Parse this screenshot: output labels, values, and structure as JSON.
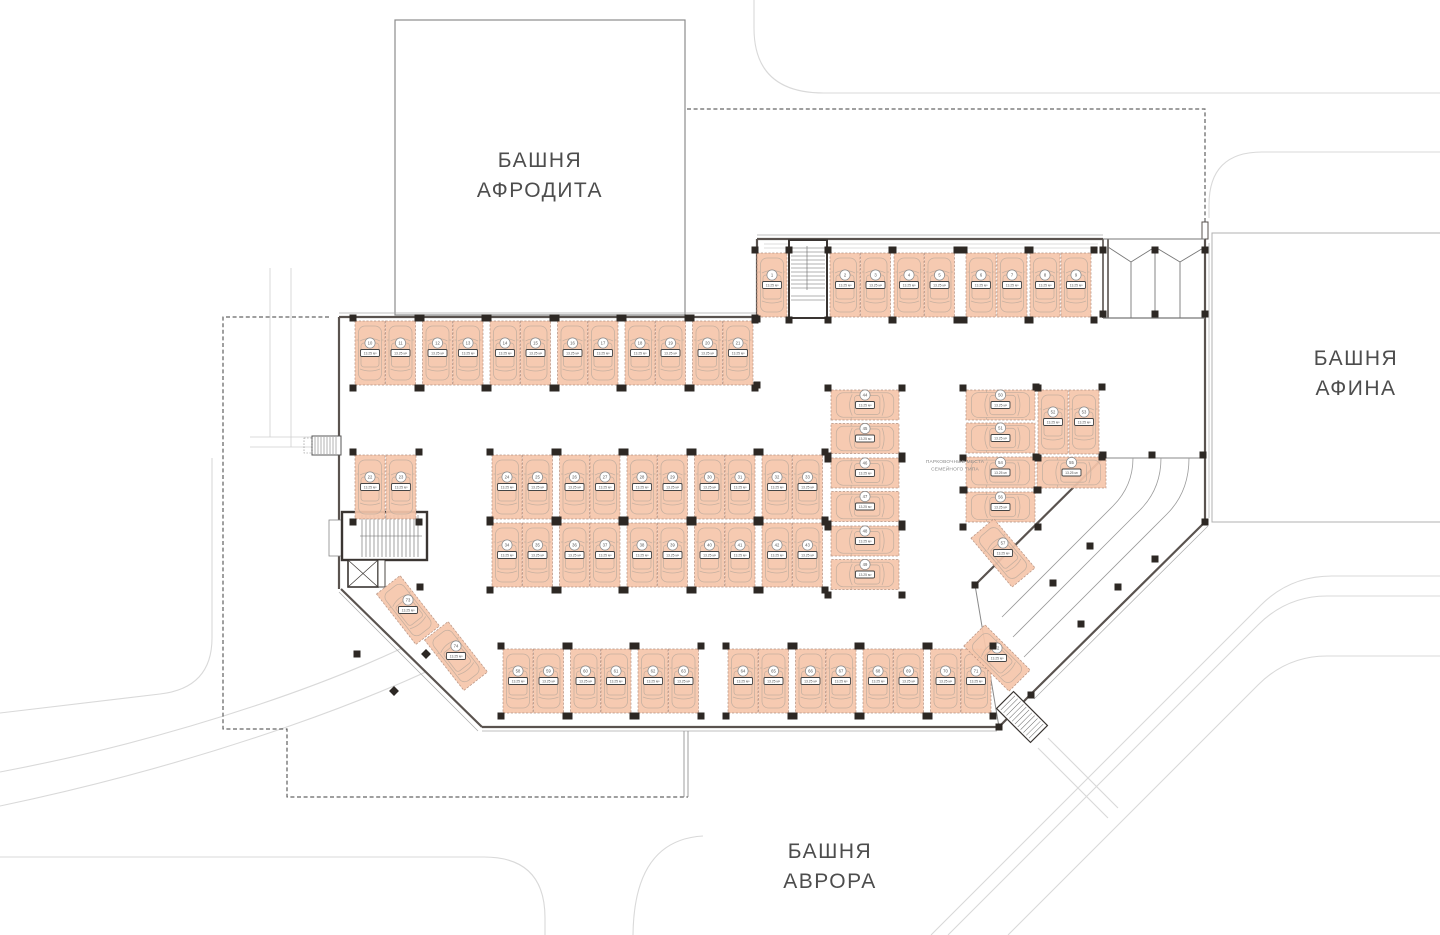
{
  "plan": {
    "towers": {
      "aphrodite": {
        "line1": "БАШНЯ",
        "line2": "АФРОДИТА"
      },
      "athena": {
        "line1": "БАШНЯ",
        "line2": "АФИНА"
      },
      "aurora": {
        "line1": "БАШНЯ",
        "line2": "АВРОРА"
      }
    },
    "annotation": {
      "line1": "ПАРКОВОЧНЫЕ МЕСТА",
      "line2": "СЕМЕЙНОГО ТИПА"
    },
    "stall_area_label": "13.25 м²",
    "total_stalls": 74,
    "colors": {
      "stall_fill": "#f5c5aa",
      "stall_border": "#b49181",
      "car_outline": "#c2ae9f",
      "wall": "#5a534f",
      "column": "#2d2824",
      "road": "#d9d9d9",
      "boundary": "#3f3f3f"
    },
    "stall_groups": [
      {
        "kind": "col-v",
        "x": 757,
        "y": 253,
        "count": 1,
        "pitch": 30.5,
        "pair_gap": 0,
        "len": 64
      },
      {
        "kind": "col-v",
        "x": 830,
        "y": 253,
        "count": 4,
        "pitch": 30.5,
        "pair_gap": 3,
        "len": 64
      },
      {
        "kind": "col-v",
        "x": 966,
        "y": 253,
        "count": 4,
        "pitch": 31,
        "pair_gap": 2,
        "len": 64
      },
      {
        "kind": "col-v",
        "x": 355,
        "y": 321,
        "count": 12,
        "pitch": 30.5,
        "pair_gap": 6.5,
        "len": 64
      },
      {
        "kind": "col-v",
        "x": 355,
        "y": 455,
        "count": 2,
        "pitch": 31,
        "pair_gap": 0,
        "len": 64
      },
      {
        "kind": "col-v",
        "x": 492,
        "y": 455,
        "count": 10,
        "pitch": 30.5,
        "pair_gap": 6.5,
        "len": 64
      },
      {
        "kind": "col-v",
        "x": 492,
        "y": 523,
        "count": 10,
        "pitch": 30.5,
        "pair_gap": 6.5,
        "len": 64
      },
      {
        "kind": "row-h",
        "x": 831,
        "y": 390,
        "count": 6,
        "pitch": 33.5,
        "pair_gap": 1,
        "len": 68
      },
      {
        "kind": "row-h",
        "x": 966,
        "y": 390,
        "count": 2,
        "pitch": 33,
        "pair_gap": 0,
        "len": 69
      },
      {
        "kind": "col-v",
        "x": 1038,
        "y": 390,
        "count": 2,
        "pitch": 31,
        "pair_gap": 0,
        "len": 64
      },
      {
        "kind": "h-x",
        "x": 966,
        "y": 457,
        "count": 2,
        "adv": 71,
        "len": 69
      },
      {
        "kind": "row-h",
        "x": 966,
        "y": 492,
        "count": 1,
        "pitch": 33,
        "pair_gap": 0,
        "len": 69
      },
      {
        "kind": "single",
        "cx": 1003,
        "cy": 553,
        "angle": -40
      },
      {
        "kind": "col-v",
        "x": 503,
        "y": 649,
        "count": 6,
        "pitch": 30.5,
        "pair_gap": 6.5,
        "len": 64
      },
      {
        "kind": "col-v",
        "x": 728,
        "y": 649,
        "count": 8,
        "pitch": 30.5,
        "pair_gap": 6.5,
        "len": 64
      },
      {
        "kind": "single",
        "cx": 997,
        "cy": 658,
        "angle": -45
      },
      {
        "kind": "single",
        "cx": 408,
        "cy": 610,
        "angle": -38
      },
      {
        "kind": "single",
        "cx": 456,
        "cy": 656,
        "angle": -38
      }
    ]
  }
}
